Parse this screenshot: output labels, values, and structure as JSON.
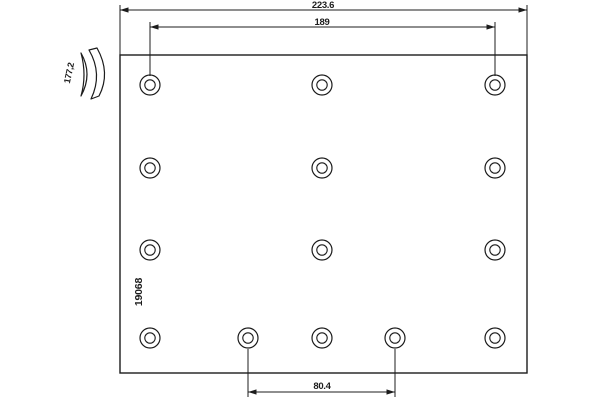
{
  "drawing": {
    "part_number": "19068",
    "dimensions": {
      "overall_width": "223.6",
      "upper_hole_span": "189",
      "lower_hole_span": "80.4",
      "lining_width": "177,2"
    },
    "colors": {
      "line": "#1c1c1c",
      "background": "#ffffff"
    },
    "plate": {
      "x": 120,
      "y": 55,
      "width": 407,
      "height": 318
    },
    "holes": {
      "outer_radius": 10,
      "inner_radius": 5.2,
      "positions": [
        {
          "x": 150,
          "y": 85
        },
        {
          "x": 322,
          "y": 85
        },
        {
          "x": 495,
          "y": 85
        },
        {
          "x": 150,
          "y": 168
        },
        {
          "x": 322,
          "y": 168
        },
        {
          "x": 495,
          "y": 168
        },
        {
          "x": 150,
          "y": 250
        },
        {
          "x": 322,
          "y": 250
        },
        {
          "x": 495,
          "y": 250
        },
        {
          "x": 150,
          "y": 338
        },
        {
          "x": 248,
          "y": 338
        },
        {
          "x": 322,
          "y": 338
        },
        {
          "x": 395,
          "y": 338
        },
        {
          "x": 495,
          "y": 338
        }
      ]
    },
    "dimension_lines": [
      {
        "name": "dimension-overall-width",
        "y": 10,
        "x1": 120,
        "x2": 527,
        "ext": [
          {
            "x": 120,
            "y1": 5,
            "y2": 55
          },
          {
            "x": 527,
            "y1": 5,
            "y2": 55
          }
        ]
      },
      {
        "name": "dimension-upper-hole-span",
        "y": 27,
        "x1": 150,
        "x2": 495,
        "ext": [
          {
            "x": 150,
            "y1": 22,
            "y2": 76
          },
          {
            "x": 495,
            "y1": 22,
            "y2": 76
          }
        ]
      },
      {
        "name": "dimension-lower-hole-span",
        "y": 392,
        "x1": 248,
        "x2": 395,
        "ext": [
          {
            "x": 248,
            "y1": 349,
            "y2": 397
          },
          {
            "x": 395,
            "y1": 349,
            "y2": 397
          }
        ]
      }
    ]
  }
}
